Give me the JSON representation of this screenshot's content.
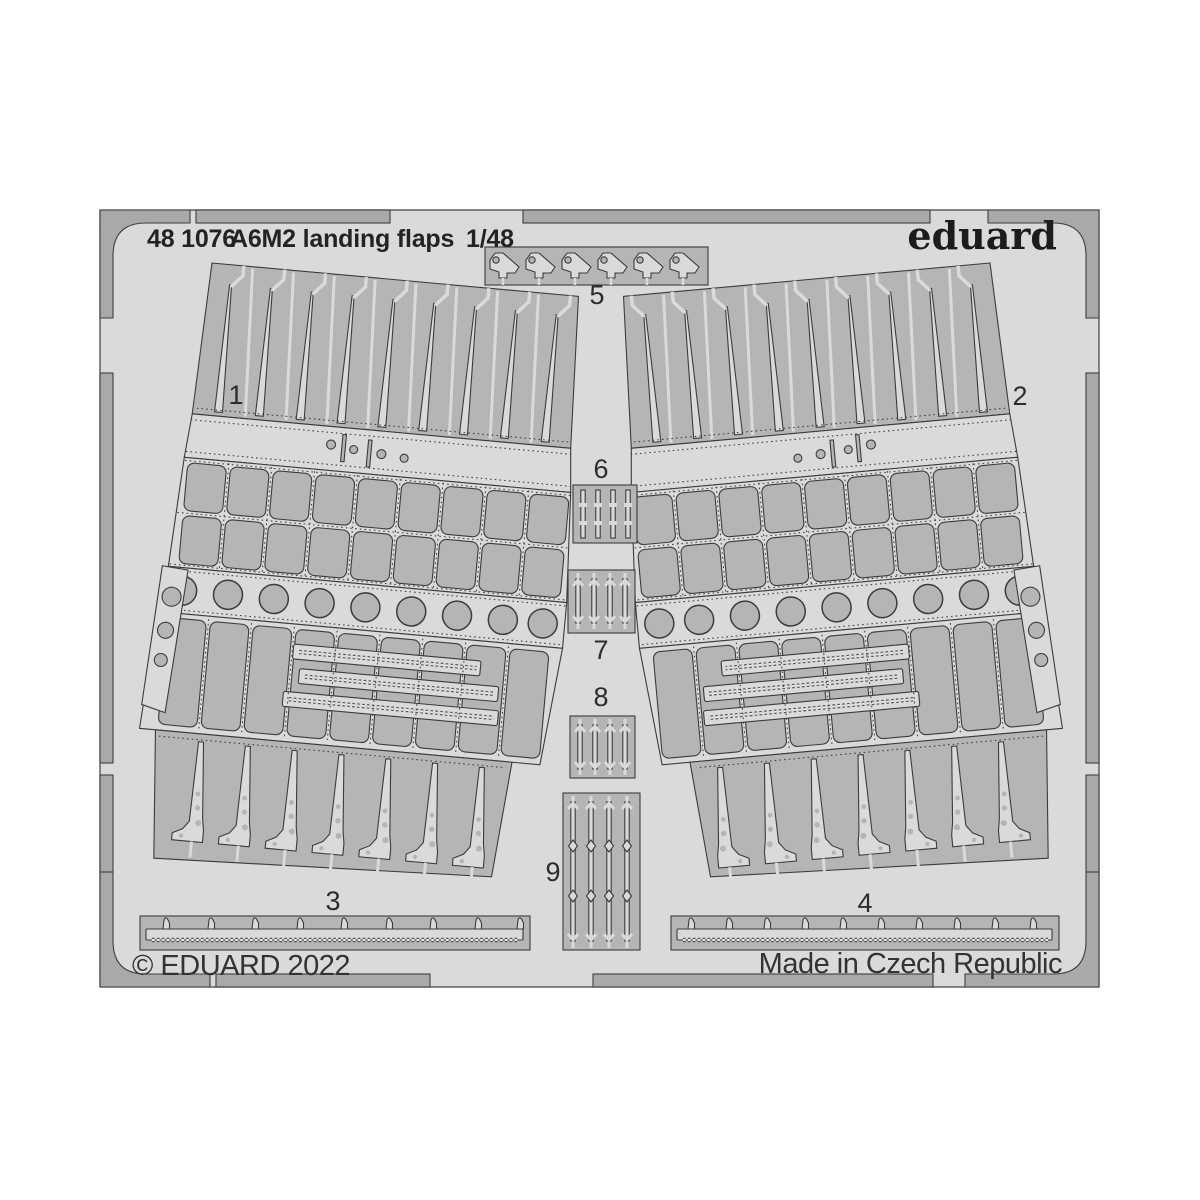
{
  "header": {
    "catalog_number": "48 1076",
    "product_name": "A6M2 landing flaps",
    "scale": "1/48",
    "brand": "eduard"
  },
  "footer": {
    "copyright": "© EDUARD 2022",
    "made_in": "Made in Czech Republic"
  },
  "part_labels": [
    "1",
    "2",
    "3",
    "4",
    "5",
    "6",
    "7",
    "8",
    "9"
  ],
  "colors": {
    "page_bg": "#ffffff",
    "sheet_bg": "#dadada",
    "frame_gray": "#a9a9a9",
    "part_gray": "#b5b5b5",
    "etched_light": "#dadada",
    "outline": "#3c3c3c",
    "text": "#262626"
  }
}
